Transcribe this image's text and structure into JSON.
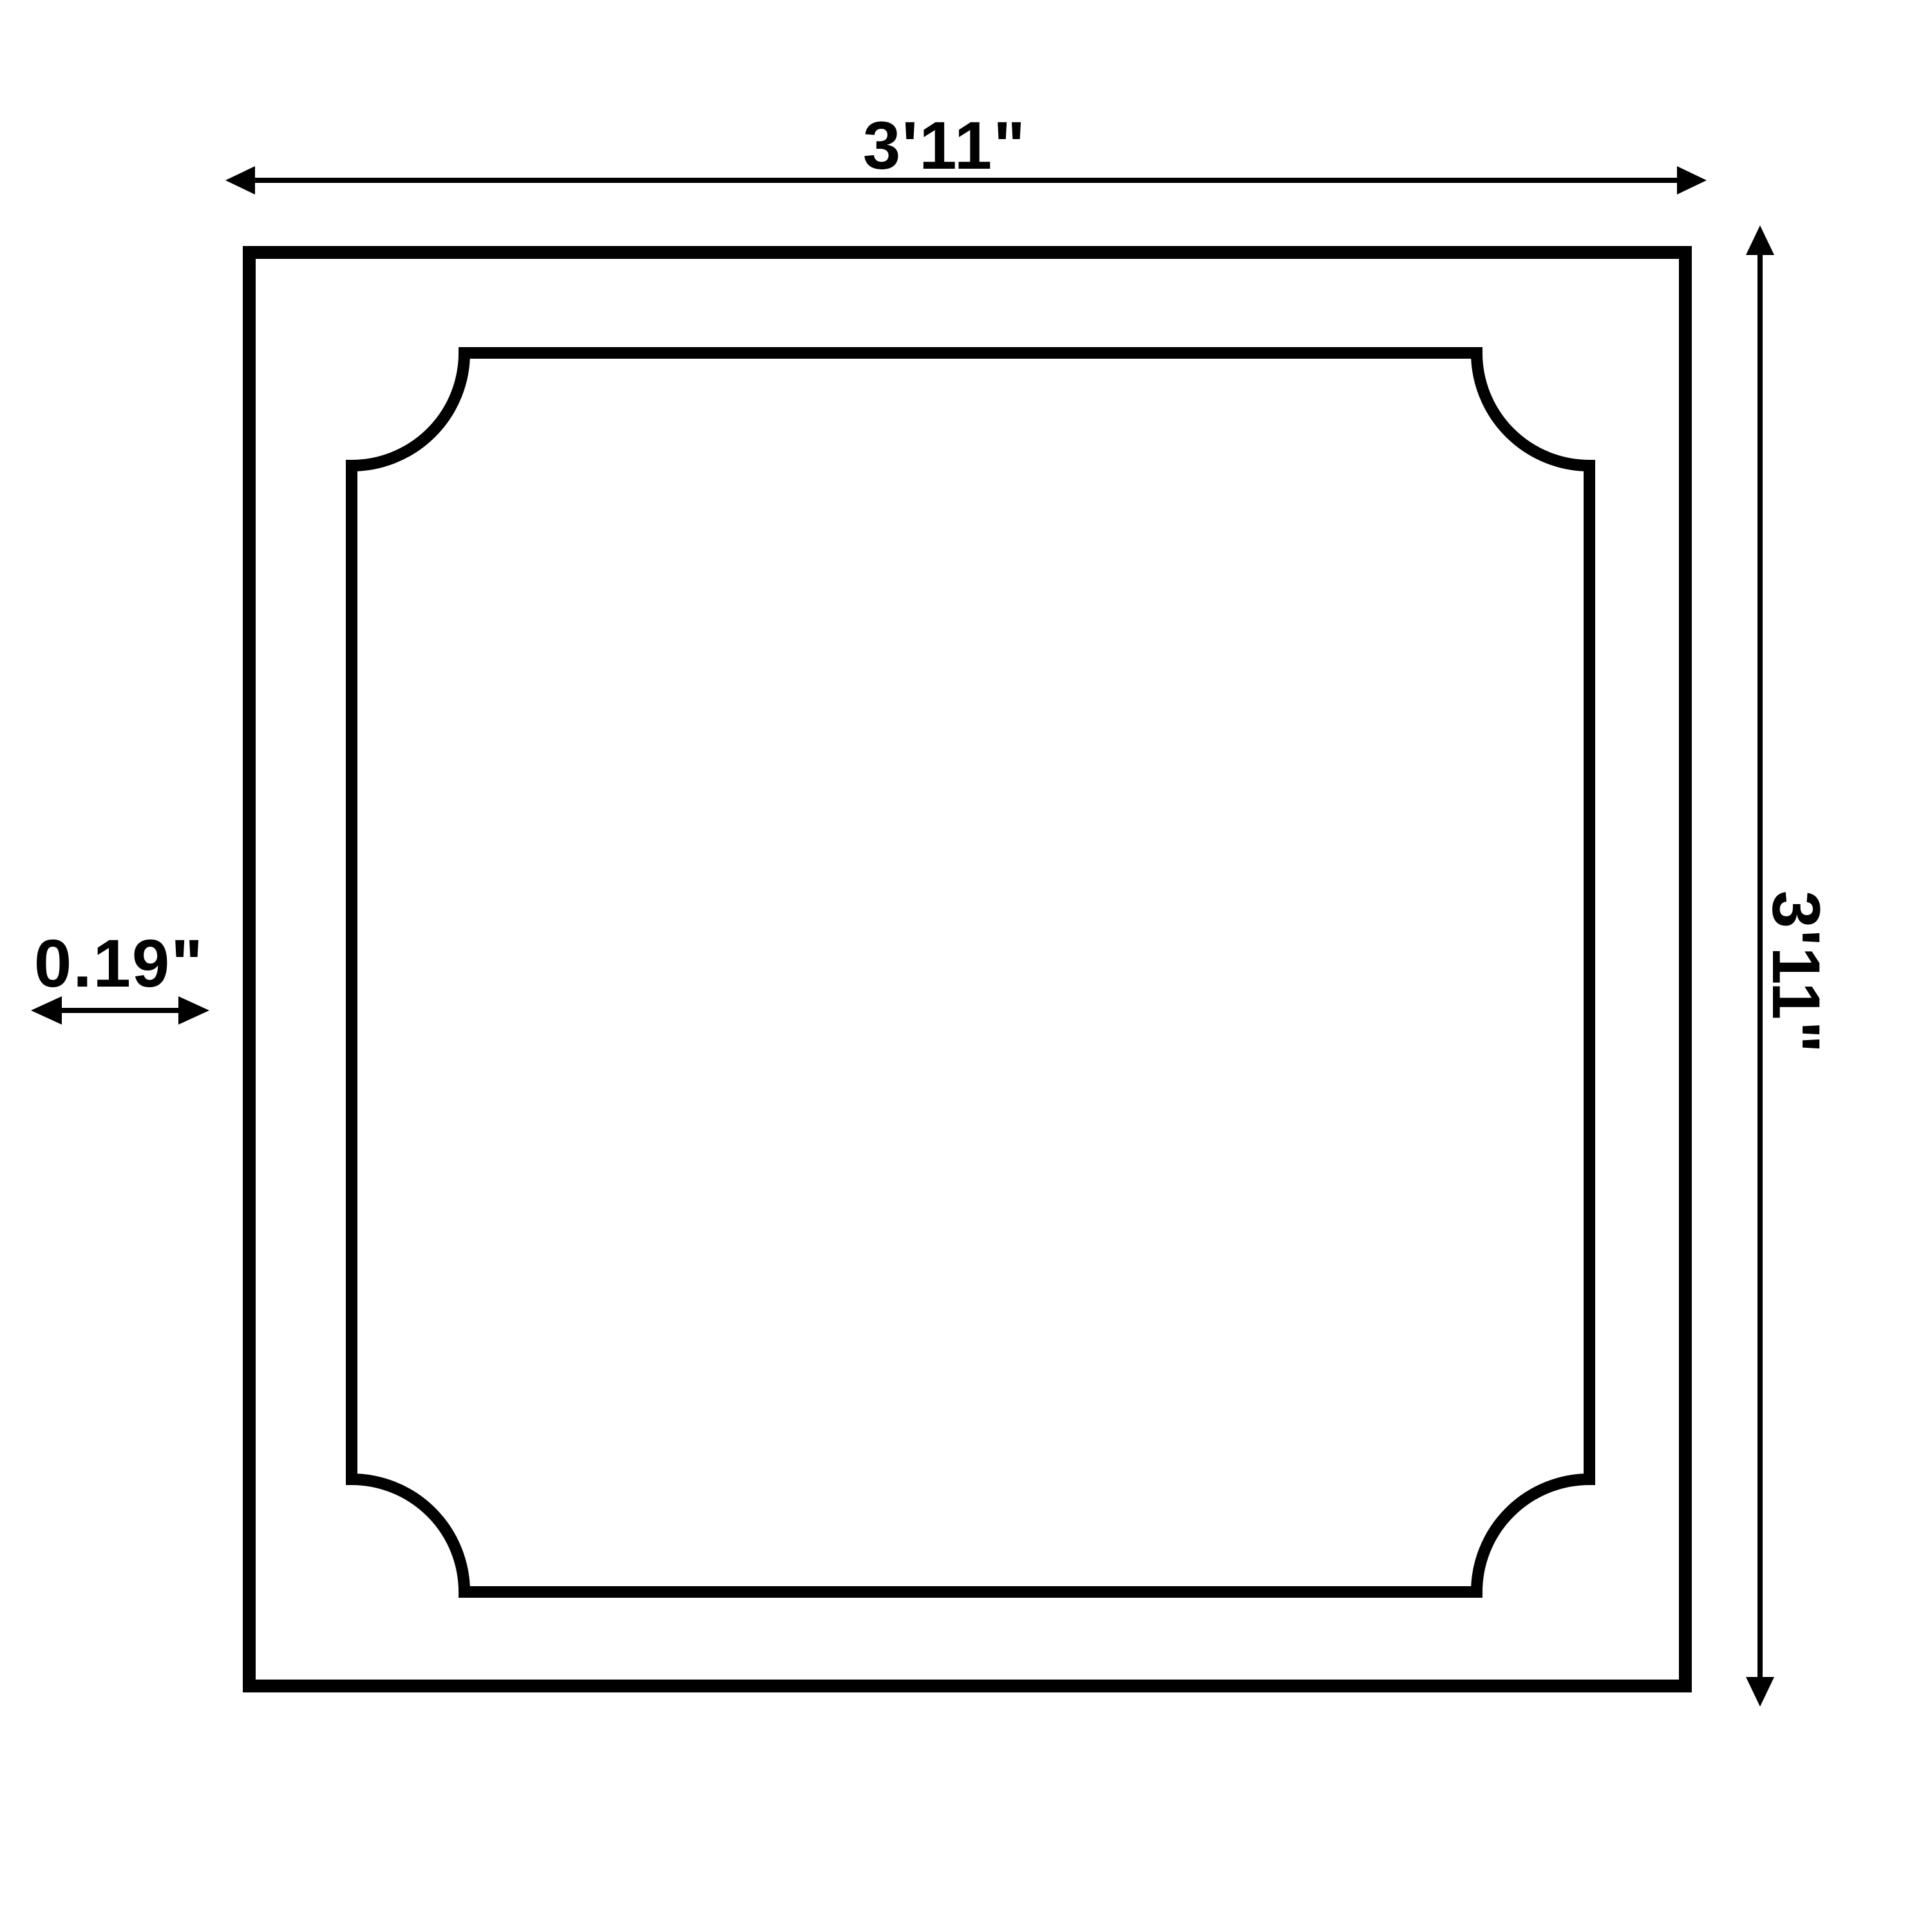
{
  "diagram": {
    "title": "square frame dimension drawing",
    "dimensions": {
      "width_label": "3'11\"",
      "height_label": "3'11\"",
      "thickness_label": "0.19\""
    },
    "colors": {
      "line": "#000000",
      "background": "#ffffff"
    }
  }
}
